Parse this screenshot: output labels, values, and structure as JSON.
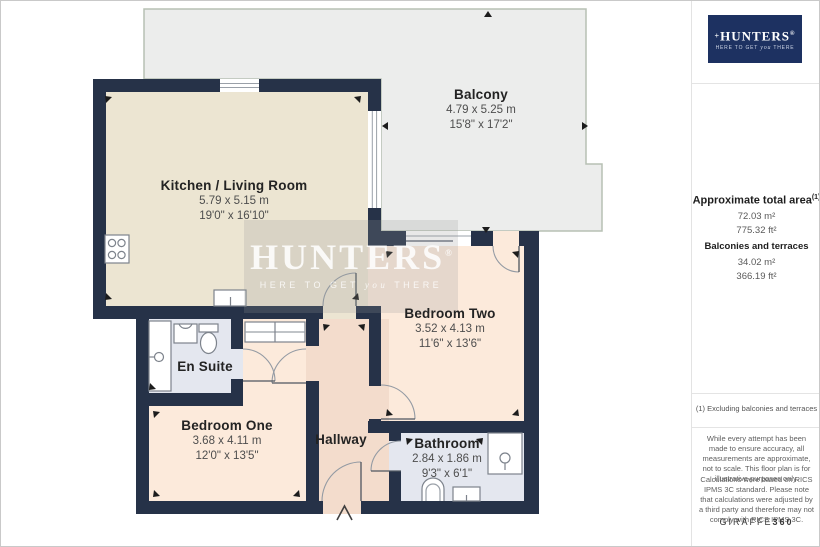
{
  "plan": {
    "rooms": [
      {
        "id": "balcony",
        "name": "Balcony",
        "metric": "4.79 x 5.25 m",
        "imperial": "15'8\" x 17'2\""
      },
      {
        "id": "kitchen_living",
        "name": "Kitchen / Living Room",
        "metric": "5.79 x 5.15 m",
        "imperial": "19'0\" x 16'10\""
      },
      {
        "id": "bedroom_two",
        "name": "Bedroom Two",
        "metric": "3.52 x 4.13 m",
        "imperial": "11'6\" x 13'6\""
      },
      {
        "id": "en_suite",
        "name": "En Suite"
      },
      {
        "id": "bedroom_one",
        "name": "Bedroom One",
        "metric": "3.68 x 4.11 m",
        "imperial": "12'0\" x 13'5\""
      },
      {
        "id": "hallway",
        "name": "Hallway"
      },
      {
        "id": "bathroom",
        "name": "Bathroom",
        "metric": "2.84 x 1.86 m",
        "imperial": "9'3\" x 6'1\""
      }
    ]
  },
  "watermark": {
    "brand": "HUNTERS",
    "registered": "®",
    "tagline_pre": "HERE TO GET",
    "tagline_script": "you",
    "tagline_post": "THERE"
  },
  "sidebar": {
    "logo": {
      "cross": "+",
      "brand": "HUNTERS",
      "registered": "®",
      "tagline_pre": "HERE TO GET",
      "tagline_script": "you",
      "tagline_post": "THERE"
    },
    "area": {
      "title": "Approximate total area",
      "title_sup": "(1)",
      "total_m2": "72.03 m²",
      "total_ft2": "775.32 ft²",
      "subtitle": "Balconies and terraces",
      "balcony_m2": "34.02 m²",
      "balcony_ft2": "366.19 ft²"
    },
    "footnote": "(1) Excluding balconies and terraces",
    "disclaimer1": "While every attempt has been made to ensure accuracy, all measurements are approximate, not to scale. This floor plan is for illustrative purposes only.",
    "disclaimer2": "Calculations were based on RICS IPMS 3C standard. Please note that calculations were adjusted by a third party and therefore may not comply with RICS IPMS 3C.",
    "attribution_brand": "GIRAFFE",
    "attribution_suffix": "360"
  },
  "colors": {
    "wall": "#263248",
    "kitchen": "#ece5d2",
    "bedroom": "#fceadb",
    "hallway": "#f3dccc",
    "wet_room": "#e4e7ef",
    "balcony": "#ecedec",
    "logo_navy": "#1d3161"
  }
}
